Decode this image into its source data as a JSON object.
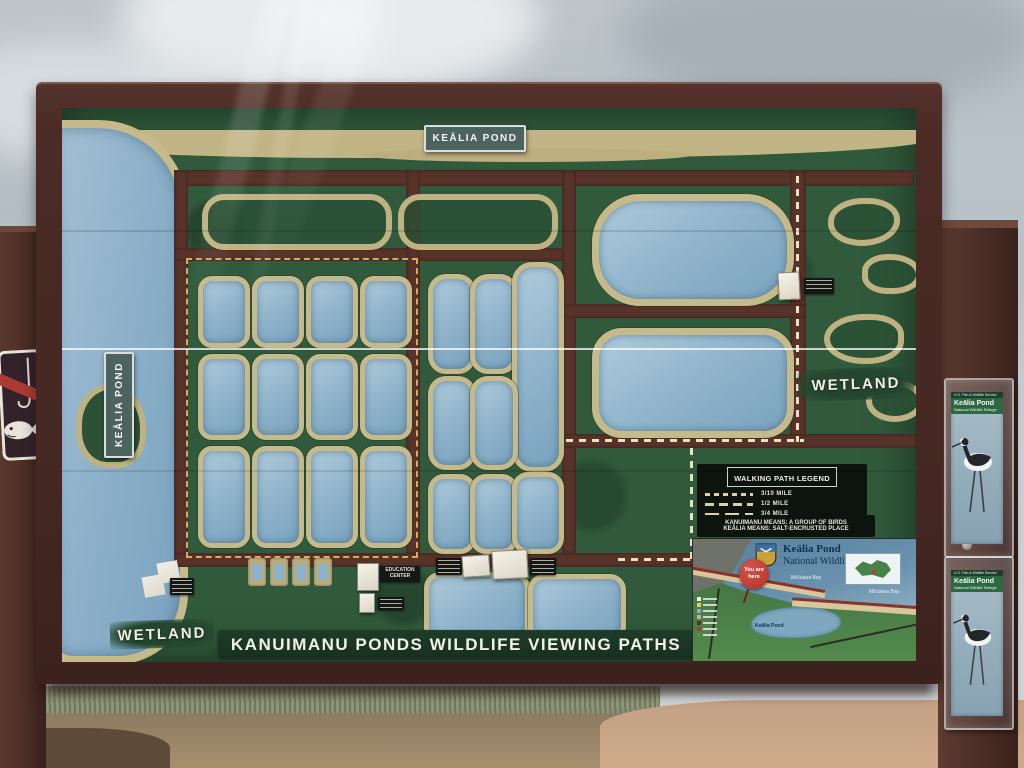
{
  "sign": {
    "top_plaque": "KEĀLIA POND",
    "left_plaque": "KEĀLIA POND",
    "title": "KANUIMANU PONDS WILDLIFE VIEWING PATHS",
    "wetland_right": "WETLAND",
    "wetland_bottom": "WETLAND",
    "education_center_label": "EDUCATION CENTER"
  },
  "legend": {
    "title": "WALKING PATH LEGEND",
    "items": [
      {
        "label": "3/10 MILE"
      },
      {
        "label": "1/2 MILE"
      },
      {
        "label": "3/4 MILE"
      }
    ],
    "notes": [
      "KANUIMANU MEANS: A GROUP OF BIRDS",
      "KEĀLIA MEANS: SALT-ENCRUSTED PLACE"
    ]
  },
  "inset_map": {
    "title_line1": "Keālia Pond",
    "title_line2": "National Wildlife Refuge",
    "you_are_here": "You are here",
    "bay_label": "Mā'alaea Bay",
    "pond_label": "Keālia Pond"
  },
  "brochure": {
    "agency": "U.S. Fish & Wildlife Service",
    "title": "Keālia Pond",
    "subtitle": "National Wildlife Refuge"
  },
  "colors": {
    "map_green": "#315a3c",
    "pond_blue": "#8db2ca",
    "shore_khaki": "#c6ba8a",
    "path_brown": "#583329",
    "frame_brown": "#4a2b26",
    "plaque_teal": "#4d6360"
  }
}
